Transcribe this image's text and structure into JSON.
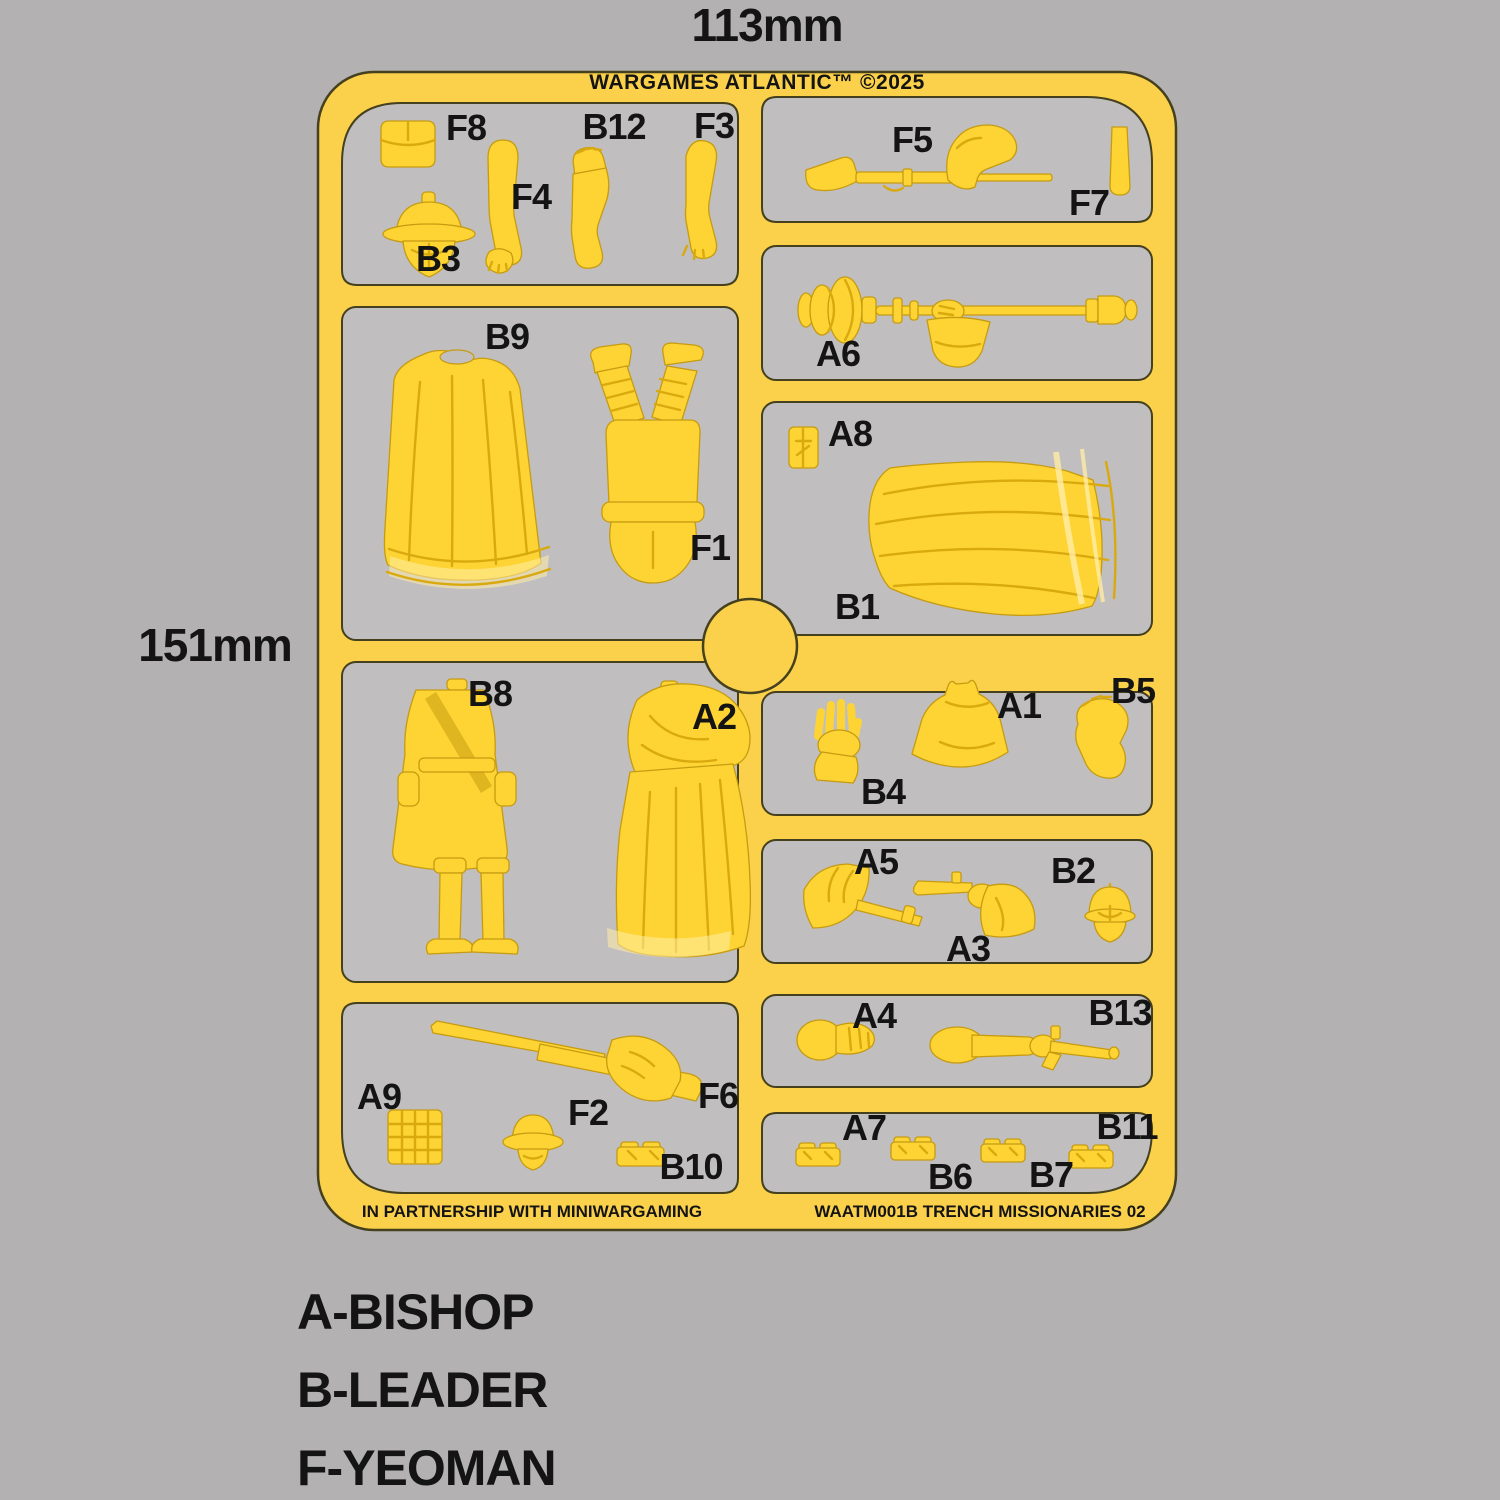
{
  "header": {
    "title": "WARGAMES ATLANTIC™ ©2025"
  },
  "dimensions": {
    "width": "113mm",
    "height": "151mm"
  },
  "footer": {
    "partnership": "IN PARTNERSHIP WITH MINIWARGAMING",
    "product_code": "WAATM001B TRENCH MISSIONARIES 02"
  },
  "legend": {
    "items": [
      {
        "label": "A-BISHOP"
      },
      {
        "label": "B-LEADER"
      },
      {
        "label": "F-YEOMAN"
      }
    ]
  },
  "colors": {
    "bg": "#b3b1b2",
    "cell": "#c0bebf",
    "sprue": "#fbd14b",
    "edge": "#45401d",
    "part": "#fdd434",
    "part_edge": "#c69b10",
    "detail": "#d9a90e",
    "hem": "#ffeca6",
    "ink": "#141414"
  },
  "parts": [
    {
      "id": "F8",
      "shape": "belt-pouch"
    },
    {
      "id": "B12",
      "shape": "clenched-fist-arm"
    },
    {
      "id": "F3",
      "shape": "bare-arm"
    },
    {
      "id": "F4",
      "shape": "sleeved-arm"
    },
    {
      "id": "B3",
      "shape": "helmeted-head"
    },
    {
      "id": "B9",
      "shape": "cape"
    },
    {
      "id": "F1",
      "shape": "legs-and-torso"
    },
    {
      "id": "B8",
      "shape": "tunic-body"
    },
    {
      "id": "A2",
      "shape": "robed-body"
    },
    {
      "id": "F5",
      "shape": "rifle-with-arm"
    },
    {
      "id": "F7",
      "shape": "scabbard-strip"
    },
    {
      "id": "A6",
      "shape": "mace-with-hand"
    },
    {
      "id": "A8",
      "shape": "small-pouch"
    },
    {
      "id": "B1",
      "shape": "robe-skirt"
    },
    {
      "id": "B4",
      "shape": "open-hand-arm"
    },
    {
      "id": "A1",
      "shape": "hood"
    },
    {
      "id": "B5",
      "shape": "bent-arm"
    },
    {
      "id": "A5",
      "shape": "armored-arm-with-blade"
    },
    {
      "id": "A3",
      "shape": "pistol-arm"
    },
    {
      "id": "B2",
      "shape": "helmeted-head"
    },
    {
      "id": "A4",
      "shape": "gloved-hand"
    },
    {
      "id": "B13",
      "shape": "pistol-arm"
    },
    {
      "id": "A9",
      "shape": "ammo-grid"
    },
    {
      "id": "F2",
      "shape": "capped-head"
    },
    {
      "id": "F6",
      "shape": "rifle-with-hand"
    },
    {
      "id": "B10",
      "shape": "pouch-pair"
    },
    {
      "id": "A7",
      "shape": "pouch-strip"
    },
    {
      "id": "B6",
      "shape": "pouch-strip"
    },
    {
      "id": "B7",
      "shape": "pouch-strip"
    },
    {
      "id": "B11",
      "shape": "pouch-strip"
    }
  ]
}
